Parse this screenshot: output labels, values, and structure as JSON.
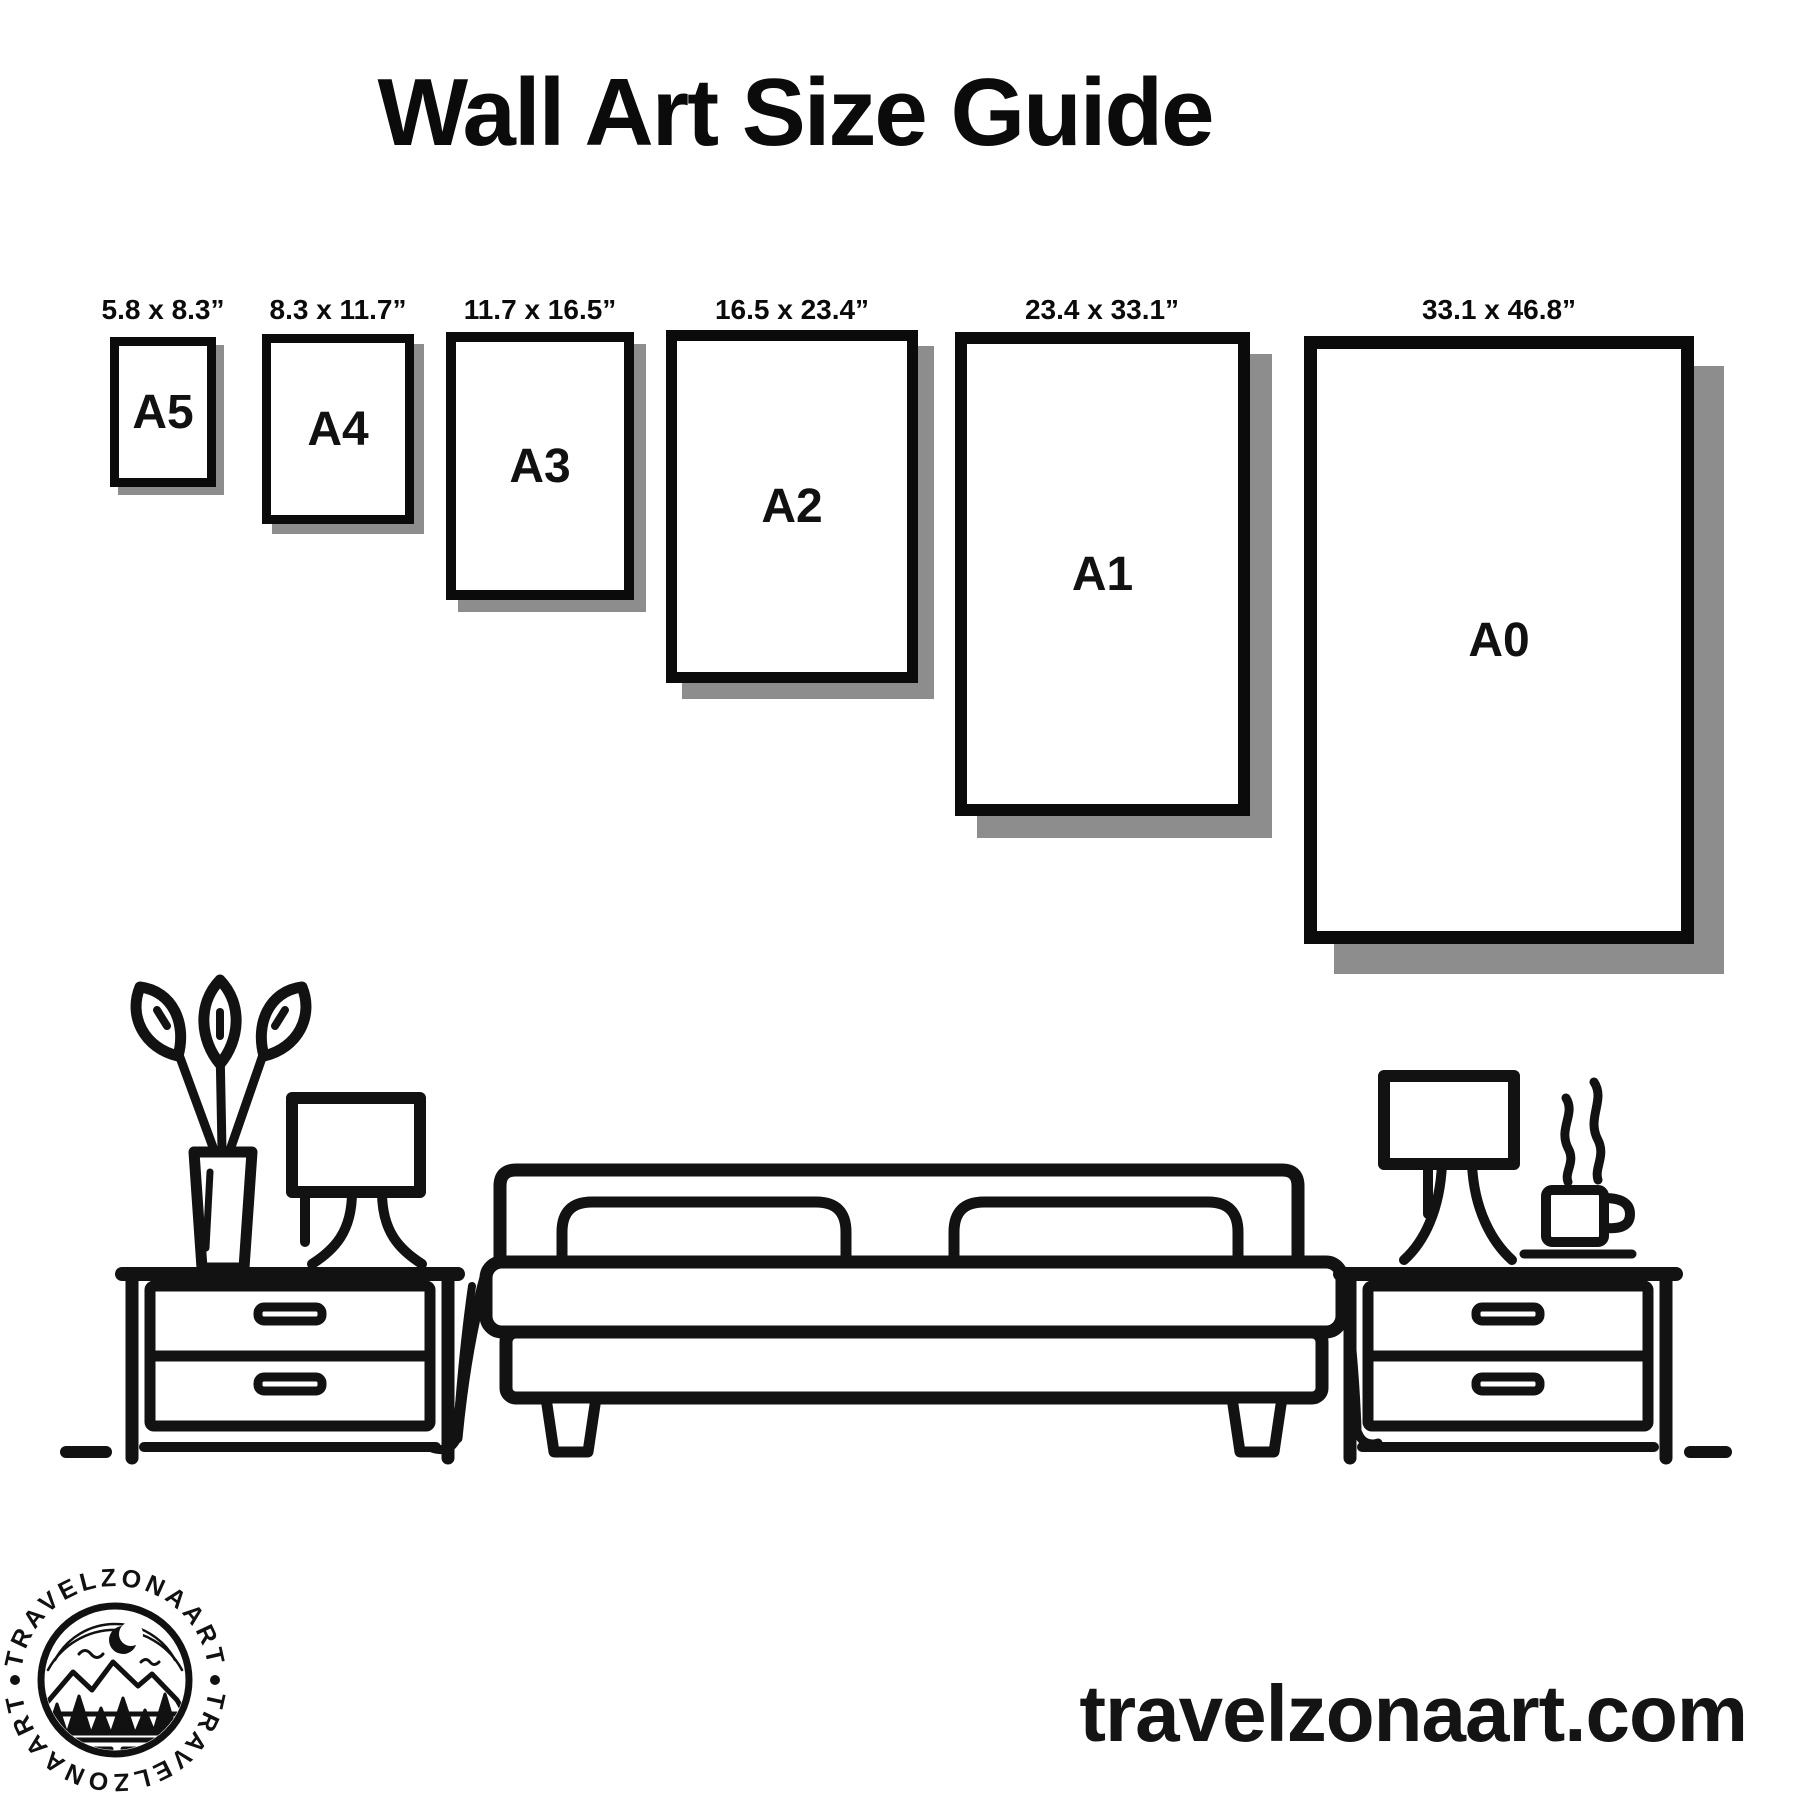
{
  "title": "Wall Art Size Guide",
  "frames": [
    {
      "name": "A5",
      "dims": "5.8 x 8.3”"
    },
    {
      "name": "A4",
      "dims": "8.3 x 11.7”"
    },
    {
      "name": "A3",
      "dims": "11.7 x 16.5”"
    },
    {
      "name": "A2",
      "dims": "16.5 x 23.4”"
    },
    {
      "name": "A1",
      "dims": "23.4 x 33.1”"
    },
    {
      "name": "A0",
      "dims": "33.1 x 46.8”"
    }
  ],
  "scene": {
    "elements": [
      "plant-vase",
      "table-lamp",
      "nightstand",
      "bed",
      "pillows",
      "blanket",
      "coffee-mug",
      "steam",
      "floor-line"
    ]
  },
  "logo": {
    "text_top": "TRAVELZONAART",
    "text_bottom": "TRAVELZONAART"
  },
  "footer": {
    "website": "travelzonaart.com"
  },
  "colors": {
    "ink": "#111111",
    "shadow": "#8d8d8d",
    "background": "#ffffff"
  }
}
